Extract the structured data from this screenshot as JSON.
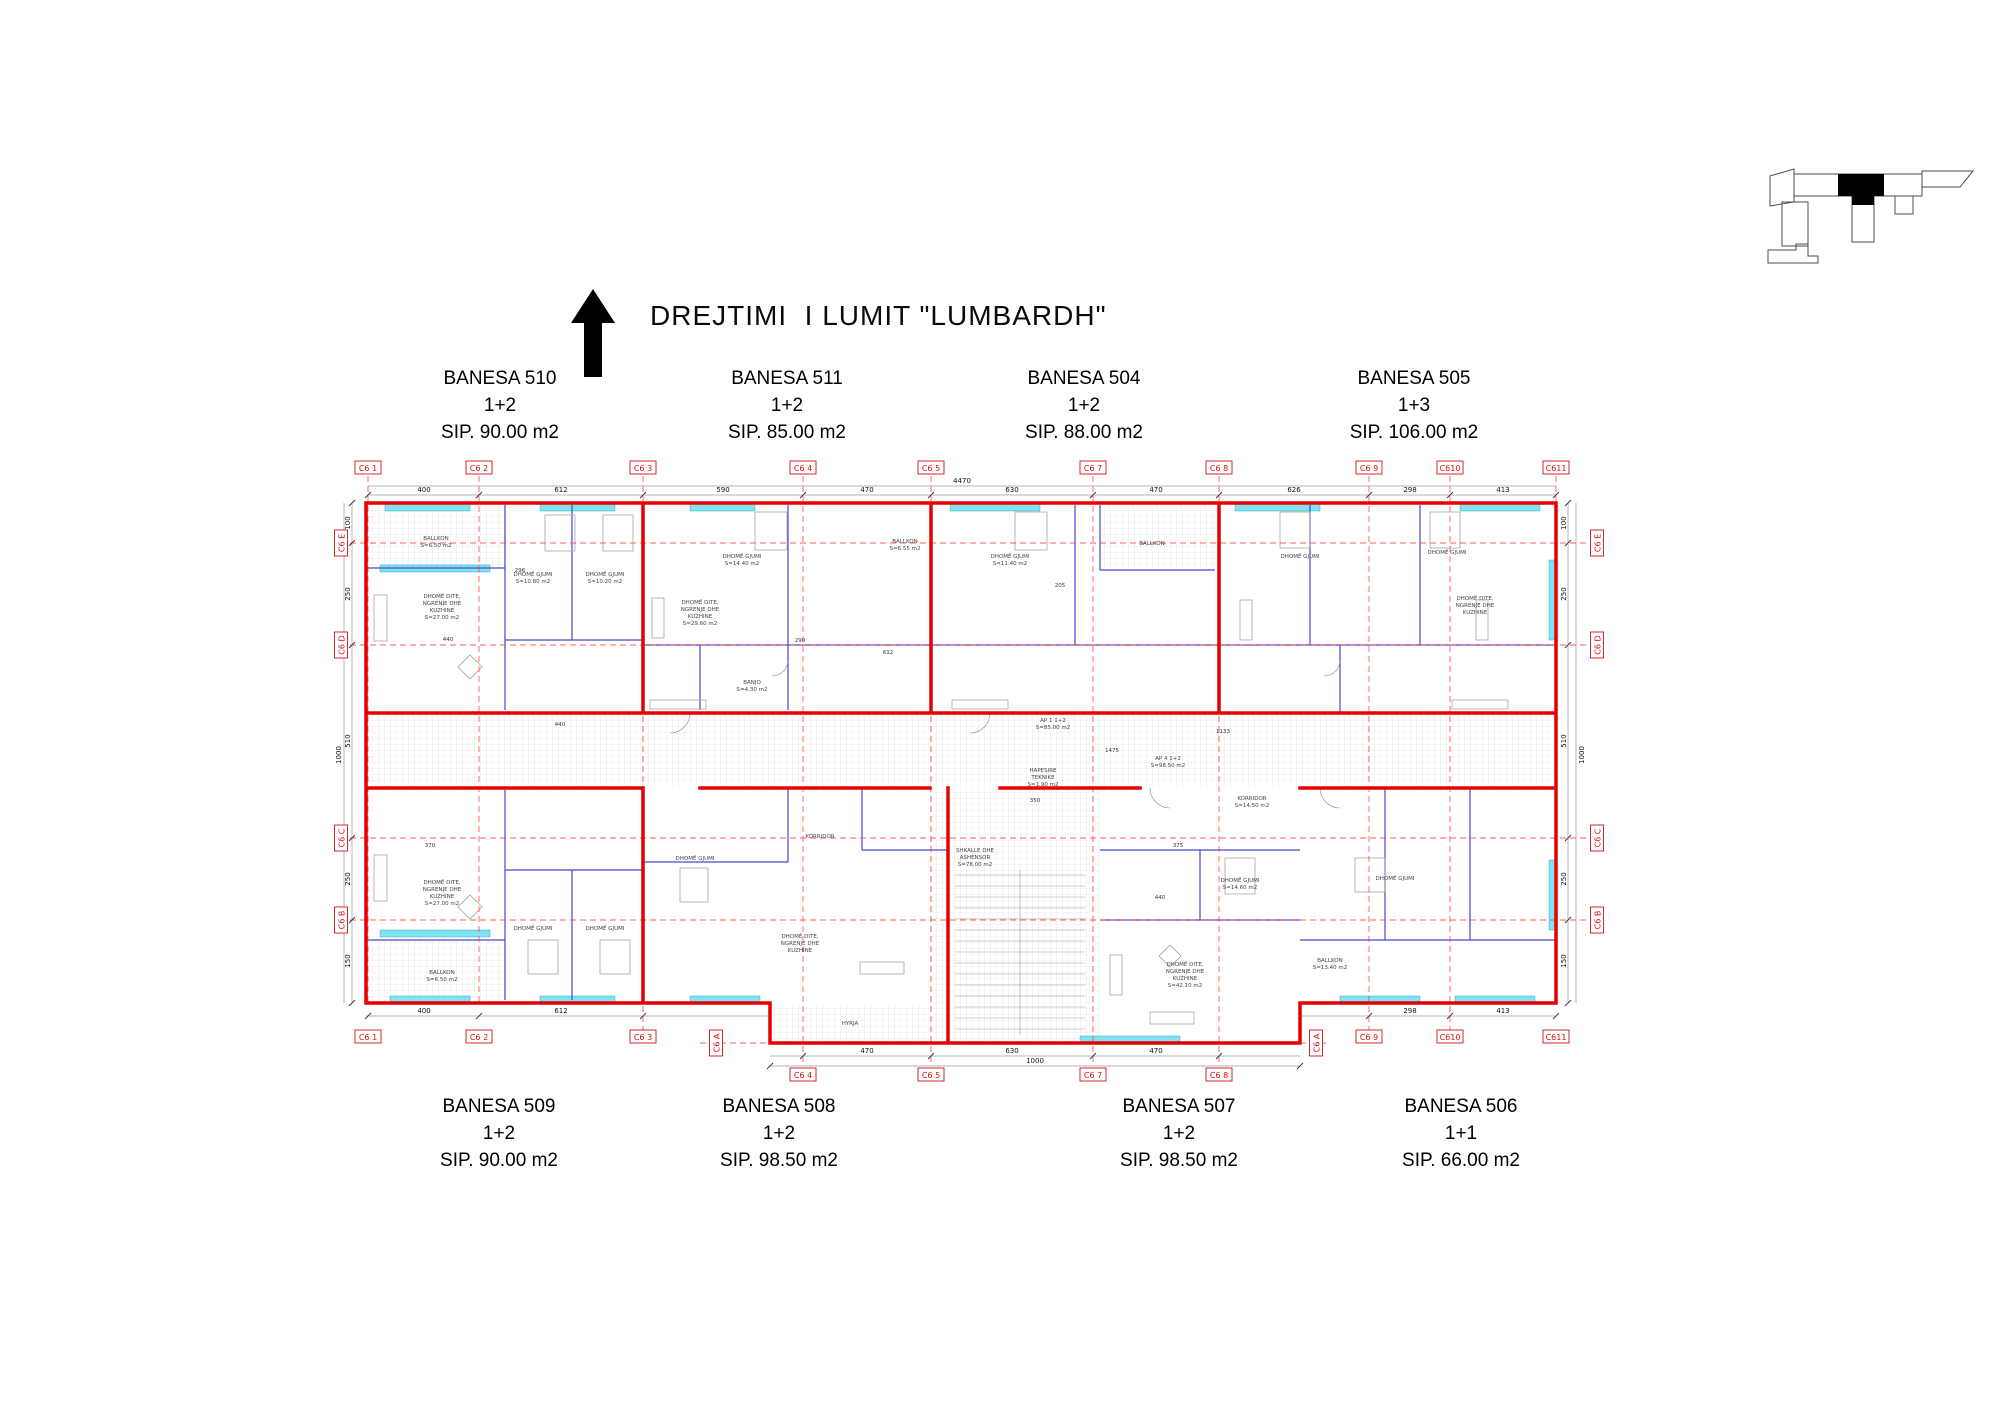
{
  "title_block": {
    "text": "DREJTIMI  I LUMIT \"LUMBARDH\"",
    "arrow": "north-arrow"
  },
  "units_top": [
    {
      "name": "BANESA 510",
      "rooms": "1+2",
      "area": "SIP. 90.00 m2"
    },
    {
      "name": "BANESA 511",
      "rooms": "1+2",
      "area": "SIP. 85.00 m2"
    },
    {
      "name": "BANESA 504",
      "rooms": "1+2",
      "area": "SIP. 88.00 m2"
    },
    {
      "name": "BANESA 505",
      "rooms": "1+3",
      "area": "SIP. 106.00 m2"
    }
  ],
  "units_bottom": [
    {
      "name": "BANESA 509",
      "rooms": "1+2",
      "area": "SIP. 90.00 m2"
    },
    {
      "name": "BANESA 508",
      "rooms": "1+2",
      "area": "SIP. 98.50 m2"
    },
    {
      "name": "BANESA 507",
      "rooms": "1+2",
      "area": "SIP. 98.50 m2"
    },
    {
      "name": "BANESA 506",
      "rooms": "1+1",
      "area": "SIP. 66.00 m2"
    }
  ],
  "grid": {
    "top": [
      "C6 1",
      "C6 2",
      "C6 3",
      "C6 4",
      "C6 5",
      "C6 7",
      "C6 8",
      "C6 9",
      "C610",
      "C611"
    ],
    "bottom_left": [
      "C6 1",
      "C6 2",
      "C6 3"
    ],
    "bottom_right": [
      "C6 9",
      "C610",
      "C611"
    ],
    "bottom_mid": [
      "C6 4",
      "C6 5",
      "C6 7",
      "C6 8"
    ],
    "left": [
      "C6 E",
      "C6 D",
      "C6 C",
      "C6 B"
    ],
    "right": [
      "C6 E",
      "C6 D",
      "C6 C",
      "C6 B"
    ],
    "axis_a_left": "C6 A",
    "axis_a_right": "C6 A"
  },
  "dims": {
    "overall_top": "4470",
    "top": [
      "400",
      "612",
      "590",
      "470",
      "630",
      "470",
      "626",
      "298",
      "413"
    ],
    "left": [
      "100",
      "250",
      "510",
      "250",
      "150"
    ],
    "left_overall": "1000",
    "right": [
      "100",
      "250",
      "510",
      "250",
      "150"
    ],
    "right_overall": "1000",
    "bottom_left": [
      "400",
      "612"
    ],
    "bottom_right": [
      "298",
      "413"
    ],
    "bottom_mid": [
      "470",
      "630",
      "470"
    ],
    "bottom_mid_overall": "1000",
    "interior": [
      "1475",
      "1133",
      "440",
      "375",
      "290",
      "612",
      "205",
      "350",
      "370",
      "296",
      "440",
      "440"
    ]
  },
  "rooms": [
    {
      "l1": "BALLKON",
      "l2": "S=6.50 m2"
    },
    {
      "l1": "DHOMË DITE,",
      "l2": "NGRENJE DHE",
      "l3": "KUZHINE",
      "l4": "S=27.00 m2"
    },
    {
      "l1": "DHOMË GJUMI",
      "l2": "S=10.80 m2"
    },
    {
      "l1": "DHOMË GJUMI",
      "l2": "S=10.20 m2"
    },
    {
      "l1": "DHOMË GJUMI",
      "l2": "S=14.40 m2"
    },
    {
      "l1": "DHOMË DITE,",
      "l2": "NGRENJE DHE",
      "l3": "KUZHINE",
      "l4": "S=29.60 m2"
    },
    {
      "l1": "BANJO",
      "l2": "S=4.30 m2"
    },
    {
      "l1": "DHOMË GJUMI",
      "l2": "S=11.40 m2"
    },
    {
      "l1": "BALLKON"
    },
    {
      "l1": "BALLKON",
      "l2": "S=6.55 m2"
    },
    {
      "l1": "DHOMË GJUMI"
    },
    {
      "l1": "DHOMË GJUMI"
    },
    {
      "l1": "DHOMË DITE,",
      "l2": "NGRENJE DHE",
      "l3": "KUZHINE"
    },
    {
      "l1": "KORRIDOR",
      "l2": "S=14.50 m2"
    },
    {
      "l1": "DHOMË GJUMI",
      "l2": "S=14.60 m2"
    },
    {
      "l1": "DHOMË GJUMI"
    },
    {
      "l1": "SHKALLE DHE",
      "l2": "ASHENSOR",
      "l3": "S=78.00 m2"
    },
    {
      "l1": "HAPESIRE",
      "l2": "TEKNIKE",
      "l3": "S=1.90 m2"
    },
    {
      "l1": "DHOMË DITE,",
      "l2": "NGRENJE DHE",
      "l3": "KUZHINE",
      "l4": "S=42.10 m2"
    },
    {
      "l1": "BALLKON",
      "l2": "S=13.40 m2"
    },
    {
      "l1": "AP 1  1+2",
      "l2": "S=85.00 m2"
    },
    {
      "l1": "AP 4  1+2",
      "l2": "S=98.50 m2"
    },
    {
      "l1": "BALLKON",
      "l2": "S=6.50 m2"
    },
    {
      "l1": "DHOMË DITE,",
      "l2": "NGRENJE DHE",
      "l3": "KUZHINE",
      "l4": "S=27.00 m2"
    },
    {
      "l1": "DHOMË GJUMI"
    },
    {
      "l1": "DHOMË GJUMI"
    },
    {
      "l1": "DHOMË GJUMI"
    },
    {
      "l1": "DHOMË DITE,",
      "l2": "NGRENJE DHE",
      "l3": "KUZHINE"
    },
    {
      "l1": "KORRIDOR"
    },
    {
      "l1": "HYRJA"
    }
  ],
  "colors": {
    "wall_red": "#e60000",
    "axis_red": "#ff4040",
    "partition_blue": "#4747cf",
    "window_cyan": "#7ee3f2",
    "bubble_red": "#d11111",
    "keyplan_highlight": "#000000"
  }
}
